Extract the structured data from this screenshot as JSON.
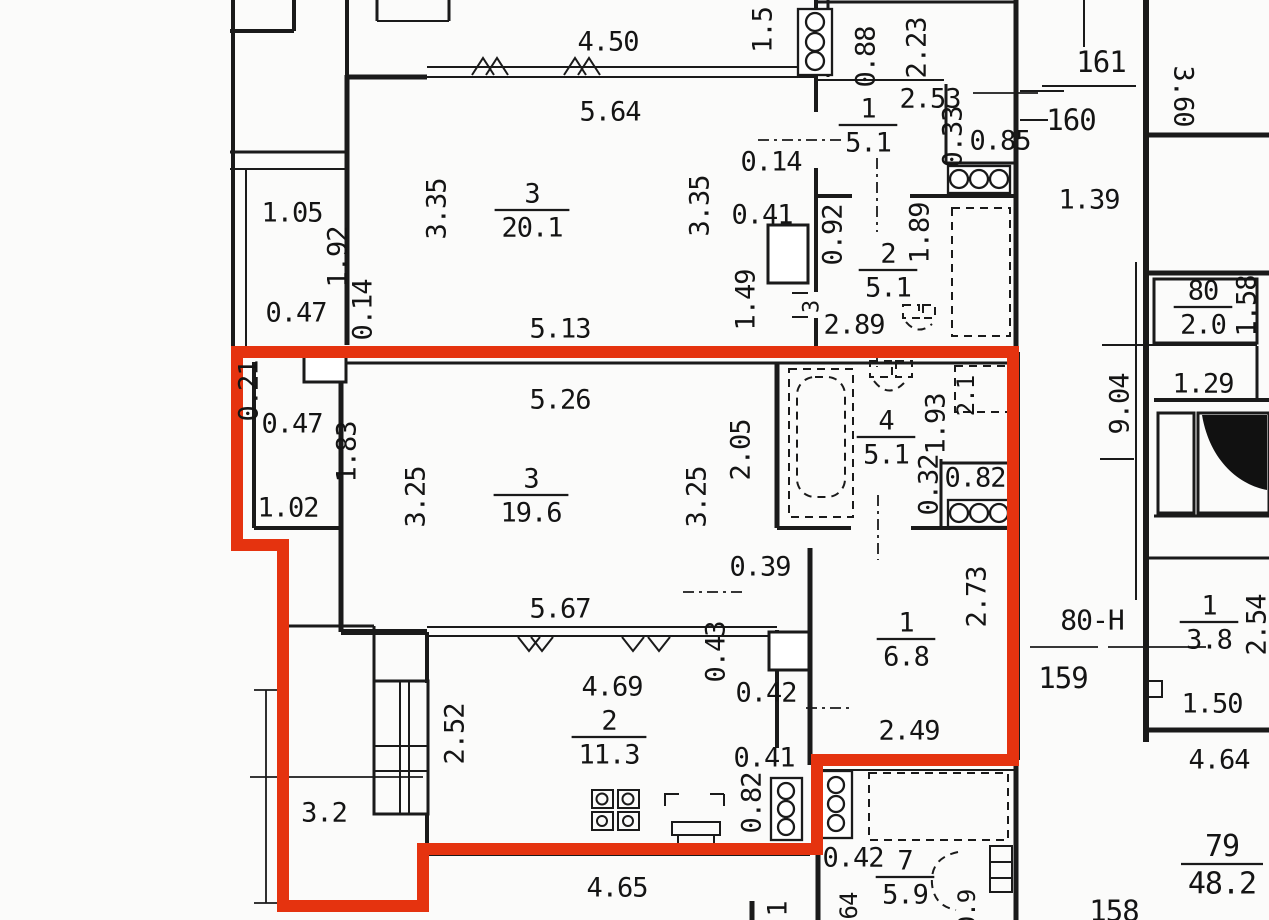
{
  "title": "apartment-floor-plan",
  "colors": {
    "highlight_red": "#e5330f",
    "wall_black": "#1a1a1a",
    "paper": "#fbfbfa"
  },
  "selected_unit_outline": {
    "points": [
      [
        237,
        352
      ],
      [
        1013,
        352
      ],
      [
        1013,
        760
      ],
      [
        817,
        760
      ],
      [
        817,
        849
      ],
      [
        423,
        849
      ],
      [
        423,
        906
      ],
      [
        283,
        906
      ],
      [
        283,
        545
      ],
      [
        237,
        545
      ]
    ],
    "stroke_width": 12
  },
  "labels": [
    {
      "text": "4.50",
      "x": 608,
      "y": 42
    },
    {
      "text": "5.64",
      "x": 610,
      "y": 112
    },
    {
      "text": "1.5",
      "x": 763,
      "y": 30,
      "rot": -90
    },
    {
      "text": "0.88",
      "x": 866,
      "y": 57,
      "rot": -90
    },
    {
      "text": "2.23",
      "x": 917,
      "y": 48,
      "rot": -90
    },
    {
      "text": "2.53",
      "x": 930,
      "y": 99
    },
    {
      "text": "161",
      "x": 1101,
      "y": 62,
      "size": 29
    },
    {
      "text": "160",
      "x": 1071,
      "y": 120,
      "size": 29
    },
    {
      "text": "3.60",
      "x": 1183,
      "y": 96,
      "rot": 90
    },
    {
      "text": "0.33",
      "x": 953,
      "y": 137,
      "rot": -90
    },
    {
      "text": "0.85",
      "x": 1000,
      "y": 141
    },
    {
      "text": "0.14",
      "x": 771,
      "y": 162
    },
    {
      "text": "1.39",
      "x": 1089,
      "y": 200
    },
    {
      "text": "3.35",
      "x": 437,
      "y": 209,
      "rot": -90
    },
    {
      "text": "3.35",
      "x": 700,
      "y": 206,
      "rot": -90
    },
    {
      "text": "0.41",
      "x": 762,
      "y": 215
    },
    {
      "text": "1.05",
      "x": 292,
      "y": 213
    },
    {
      "text": "1.92",
      "x": 338,
      "y": 257,
      "rot": -90
    },
    {
      "text": "0.92",
      "x": 833,
      "y": 235,
      "rot": -90
    },
    {
      "text": "1.89",
      "x": 920,
      "y": 233,
      "rot": -90
    },
    {
      "text": "1.49",
      "x": 746,
      "y": 300,
      "rot": -90
    },
    {
      "text": "0.47",
      "x": 296,
      "y": 313
    },
    {
      "text": "0.14",
      "x": 363,
      "y": 310,
      "rot": -90
    },
    {
      "text": "5.13",
      "x": 560,
      "y": 329
    },
    {
      "text": "2.89",
      "x": 854,
      "y": 325
    },
    {
      "text": "3",
      "x": 812,
      "y": 307,
      "rot": -90,
      "size": 22
    },
    {
      "text": "1.58",
      "x": 1247,
      "y": 306,
      "rot": -90
    },
    {
      "text": "1.29",
      "x": 1203,
      "y": 384
    },
    {
      "text": "9.04",
      "x": 1120,
      "y": 404,
      "rot": -90
    },
    {
      "text": "0.21",
      "x": 249,
      "y": 391,
      "rot": -90
    },
    {
      "text": "0.47",
      "x": 292,
      "y": 424
    },
    {
      "text": "1.83",
      "x": 347,
      "y": 452,
      "rot": -90
    },
    {
      "text": "5.26",
      "x": 560,
      "y": 400
    },
    {
      "text": "3.25",
      "x": 416,
      "y": 497,
      "rot": -90
    },
    {
      "text": "3.25",
      "x": 697,
      "y": 497,
      "rot": -90
    },
    {
      "text": "1.02",
      "x": 288,
      "y": 508
    },
    {
      "text": "2.05",
      "x": 741,
      "y": 450,
      "rot": -90
    },
    {
      "text": "1.93",
      "x": 936,
      "y": 424,
      "rot": -90
    },
    {
      "text": "2.1",
      "x": 966,
      "y": 396,
      "rot": -90,
      "size": 24
    },
    {
      "text": "0.32",
      "x": 929,
      "y": 485,
      "rot": -90
    },
    {
      "text": "0.82",
      "x": 975,
      "y": 478
    },
    {
      "text": "0.39",
      "x": 760,
      "y": 567
    },
    {
      "text": "5.67",
      "x": 560,
      "y": 609
    },
    {
      "text": "2.73",
      "x": 977,
      "y": 597,
      "rot": -90
    },
    {
      "text": "80-H",
      "x": 1092,
      "y": 620,
      "size": 28
    },
    {
      "text": "2.54",
      "x": 1257,
      "y": 625,
      "rot": -90
    },
    {
      "text": "159",
      "x": 1063,
      "y": 678,
      "size": 29
    },
    {
      "text": "0.43",
      "x": 716,
      "y": 652,
      "rot": -90
    },
    {
      "text": "0.42",
      "x": 766,
      "y": 693
    },
    {
      "text": "2.49",
      "x": 909,
      "y": 731
    },
    {
      "text": "4.69",
      "x": 612,
      "y": 687
    },
    {
      "text": "2.52",
      "x": 455,
      "y": 734,
      "rot": -90
    },
    {
      "text": "3.2",
      "x": 324,
      "y": 813
    },
    {
      "text": "1.50",
      "x": 1212,
      "y": 704
    },
    {
      "text": "4.64",
      "x": 1219,
      "y": 760
    },
    {
      "text": "0.41",
      "x": 764,
      "y": 758
    },
    {
      "text": "0.82",
      "x": 752,
      "y": 803,
      "rot": -90
    },
    {
      "text": "0.42",
      "x": 853,
      "y": 858
    },
    {
      "text": "64",
      "x": 849,
      "y": 906,
      "rot": -90,
      "size": 24
    },
    {
      "text": "1",
      "x": 778,
      "y": 909,
      "rot": -90
    },
    {
      "text": "4.65",
      "x": 617,
      "y": 888
    },
    {
      "text": "0.9",
      "x": 967,
      "y": 910,
      "rot": -90,
      "size": 24
    },
    {
      "text": "158",
      "x": 1114,
      "y": 911,
      "size": 29
    }
  ],
  "rooms": [
    {
      "num": "1",
      "den": "5.1",
      "x": 868,
      "y": 124
    },
    {
      "num": "3",
      "den": "20.1",
      "x": 532,
      "y": 209
    },
    {
      "num": "2",
      "den": "5.1",
      "x": 888,
      "y": 269
    },
    {
      "num": "80",
      "den": "2.0",
      "x": 1203,
      "y": 306
    },
    {
      "num": "3",
      "den": "19.6",
      "x": 531,
      "y": 494
    },
    {
      "num": "4",
      "den": "5.1",
      "x": 886,
      "y": 436
    },
    {
      "num": "1",
      "den": "6.8",
      "x": 906,
      "y": 638
    },
    {
      "num": "1",
      "den": "3.8",
      "x": 1209,
      "y": 621
    },
    {
      "num": "2",
      "den": "11.3",
      "x": 609,
      "y": 736
    },
    {
      "num": "7",
      "den": "5.9",
      "x": 905,
      "y": 876
    },
    {
      "num": "79",
      "den": "48.2",
      "x": 1222,
      "y": 863,
      "size": 30
    }
  ]
}
